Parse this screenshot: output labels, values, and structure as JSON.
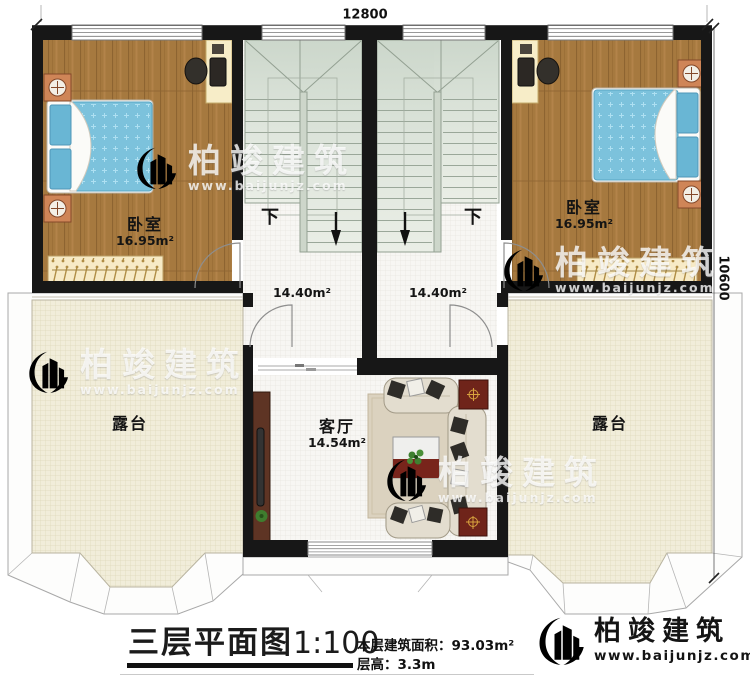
{
  "dimensions": {
    "top_width": "12800",
    "right_depth": "10600"
  },
  "rooms": {
    "bedroom_left": {
      "name": "卧室",
      "area": "16.95m²"
    },
    "bedroom_right": {
      "name": "卧室",
      "area": "16.95m²"
    },
    "stair_hall_left": {
      "area": "14.40m²",
      "down_label": "下"
    },
    "stair_hall_right": {
      "area": "14.40m²",
      "down_label": "下"
    },
    "terrace_left": {
      "name": "露台"
    },
    "terrace_right": {
      "name": "露台"
    },
    "living_room": {
      "name": "客厅",
      "area": "14.54m²"
    }
  },
  "title_block": {
    "title": "三层平面图",
    "scale": "1:100",
    "area_line": "本层建筑面积：93.03m²",
    "floor_height_line": "层高：3.3m"
  },
  "branding": {
    "company": "柏竣建筑",
    "website": "www.baijunjz.com"
  },
  "watermark": {
    "company": "柏竣建筑",
    "website": "www.baijunjz.com"
  },
  "colors": {
    "wall": "#171717",
    "wood_floor": "#a6793f",
    "terrace_floor": "#f1edda",
    "stair": "#dfe6dd",
    "bed": "#7cc2dc",
    "logo_blue": "#1b5fa7",
    "logo_orange": "#f39417"
  }
}
